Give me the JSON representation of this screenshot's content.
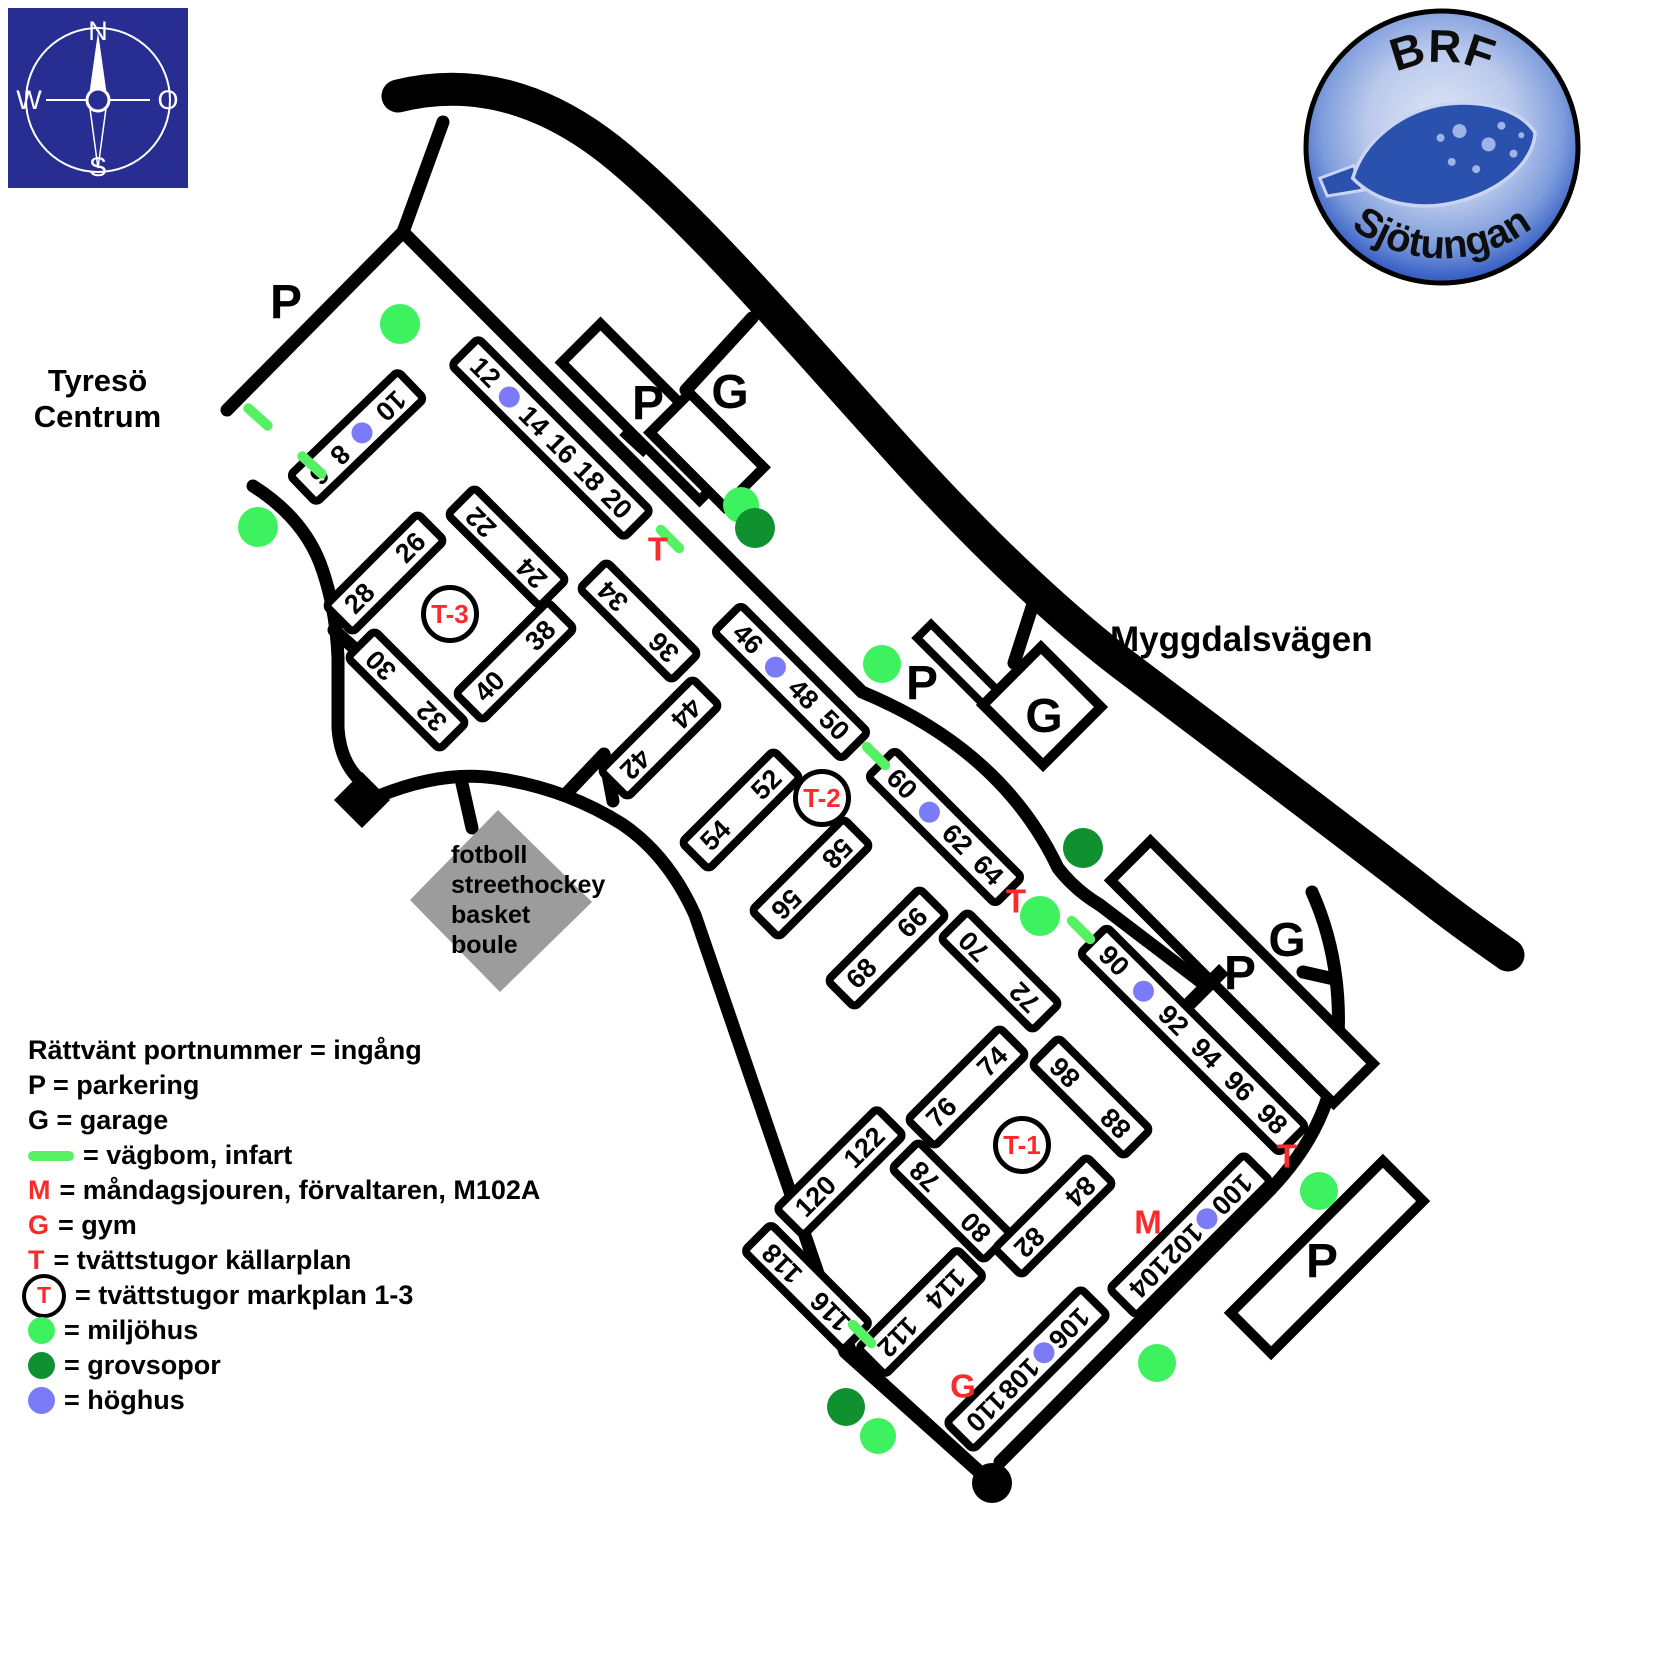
{
  "compass": {
    "n": "N",
    "e": "O",
    "s": "S",
    "w": "W"
  },
  "logo": {
    "top": "BRF",
    "name": "Sjötungan"
  },
  "labels": {
    "area_line1": "Tyresö",
    "area_line2": "Centrum",
    "street": "Myggdalsvägen"
  },
  "sport_field": [
    "fotboll",
    "streethockey",
    "basket",
    "boule"
  ],
  "legend": [
    {
      "sym": "none",
      "text": "Rättvänt portnummer = ingång"
    },
    {
      "sym": "none",
      "text": "P = parkering"
    },
    {
      "sym": "none",
      "text": "G = garage"
    },
    {
      "sym": "line",
      "text": "= vägbom, infart"
    },
    {
      "sym": "M",
      "text": "= måndagsjouren, förvaltaren, M102A"
    },
    {
      "sym": "G",
      "text": "= gym"
    },
    {
      "sym": "T",
      "text": "= tvättstugor källarplan"
    },
    {
      "sym": "circleT",
      "text": "= tvättstugor markplan 1-3"
    },
    {
      "sym": "dot-light",
      "text": "= miljöhus"
    },
    {
      "sym": "dot-dark",
      "text": "= grovsopor"
    },
    {
      "sym": "dot-blue",
      "text": "= höghus"
    }
  ],
  "colors": {
    "miljohus": "#3ef15f",
    "grovsopor": "#0f9130",
    "hoghus": "#7b7bf7",
    "red_letter": "#fb2b2b",
    "vagbom": "#55f163",
    "compass_blue": "#272d91"
  },
  "map": {
    "buildings": [
      {
        "id": "6-10",
        "cx": 357,
        "cy": 437,
        "len": 158,
        "angle": -44,
        "items": [
          {
            "t": "6",
            "flip": true
          },
          {
            "t": "8",
            "flip": true
          },
          {
            "dot": true
          },
          {
            "t": "10",
            "flip": true
          }
        ]
      },
      {
        "id": "12-20",
        "cx": 551,
        "cy": 438,
        "len": 252,
        "angle": 45,
        "items": [
          {
            "t": "12"
          },
          {
            "dot": true
          },
          {
            "t": "14"
          },
          {
            "t": "16"
          },
          {
            "t": "18"
          },
          {
            "t": "20"
          }
        ]
      },
      {
        "id": "22-24",
        "cx": 507,
        "cy": 547,
        "len": 138,
        "angle": 45,
        "items": [
          {
            "t": "22",
            "flip": true
          },
          {
            "t": "24",
            "flip": true
          }
        ]
      },
      {
        "id": "26-28",
        "cx": 385,
        "cy": 573,
        "len": 138,
        "angle": -45,
        "items": [
          {
            "t": "28"
          },
          {
            "t": "26"
          }
        ]
      },
      {
        "id": "30-32",
        "cx": 407,
        "cy": 690,
        "len": 138,
        "angle": 45,
        "items": [
          {
            "t": "30",
            "flip": true
          },
          {
            "t": "32",
            "flip": true
          }
        ]
      },
      {
        "id": "34-36",
        "cx": 639,
        "cy": 621,
        "len": 138,
        "angle": 45,
        "items": [
          {
            "t": "34",
            "flip": true
          },
          {
            "t": "36",
            "flip": true
          }
        ]
      },
      {
        "id": "38-40",
        "cx": 515,
        "cy": 661,
        "len": 138,
        "angle": -45,
        "items": [
          {
            "t": "40"
          },
          {
            "t": "38"
          }
        ]
      },
      {
        "id": "42-44",
        "cx": 660,
        "cy": 738,
        "len": 138,
        "angle": -45,
        "items": [
          {
            "t": "42",
            "flip": true
          },
          {
            "t": "44",
            "flip": true
          }
        ]
      },
      {
        "id": "46-50",
        "cx": 791,
        "cy": 682,
        "len": 188,
        "angle": 45,
        "items": [
          {
            "t": "46"
          },
          {
            "dot": true
          },
          {
            "t": "48"
          },
          {
            "t": "50"
          }
        ]
      },
      {
        "id": "52-54",
        "cx": 741,
        "cy": 810,
        "len": 138,
        "angle": -45,
        "items": [
          {
            "t": "54"
          },
          {
            "t": "52"
          }
        ]
      },
      {
        "id": "56-58",
        "cx": 811,
        "cy": 878,
        "len": 138,
        "angle": -45,
        "items": [
          {
            "t": "56",
            "flip": true
          },
          {
            "t": "58",
            "flip": true
          }
        ]
      },
      {
        "id": "60-64",
        "cx": 945,
        "cy": 827,
        "len": 188,
        "angle": 45,
        "items": [
          {
            "t": "60"
          },
          {
            "dot": true
          },
          {
            "t": "62"
          },
          {
            "t": "64"
          }
        ]
      },
      {
        "id": "66-68",
        "cx": 887,
        "cy": 948,
        "len": 138,
        "angle": -45,
        "items": [
          {
            "t": "68"
          },
          {
            "t": "66"
          }
        ]
      },
      {
        "id": "70-72",
        "cx": 1000,
        "cy": 971,
        "len": 138,
        "angle": 45,
        "items": [
          {
            "t": "70",
            "flip": true
          },
          {
            "t": "72",
            "flip": true
          }
        ]
      },
      {
        "id": "74-76",
        "cx": 967,
        "cy": 1087,
        "len": 138,
        "angle": -45,
        "items": [
          {
            "t": "76"
          },
          {
            "t": "74"
          }
        ]
      },
      {
        "id": "86-88",
        "cx": 1091,
        "cy": 1097,
        "len": 138,
        "angle": 45,
        "items": [
          {
            "t": "86",
            "flip": true
          },
          {
            "t": "88",
            "flip": true
          }
        ]
      },
      {
        "id": "90-98",
        "cx": 1193,
        "cy": 1040,
        "len": 290,
        "angle": 45,
        "items": [
          {
            "t": "90"
          },
          {
            "dot": true
          },
          {
            "t": "92"
          },
          {
            "t": "94"
          },
          {
            "t": "96"
          },
          {
            "t": "98"
          }
        ]
      },
      {
        "id": "78-80",
        "cx": 951,
        "cy": 1201,
        "len": 138,
        "angle": 45,
        "items": [
          {
            "t": "78",
            "flip": true
          },
          {
            "t": "80",
            "flip": true
          }
        ]
      },
      {
        "id": "82-84",
        "cx": 1054,
        "cy": 1216,
        "len": 138,
        "angle": -45,
        "items": [
          {
            "t": "82",
            "flip": true
          },
          {
            "t": "84",
            "flip": true
          }
        ]
      },
      {
        "id": "120-122",
        "cx": 840,
        "cy": 1172,
        "len": 150,
        "angle": -45,
        "items": [
          {
            "t": "120"
          },
          {
            "t": "122"
          }
        ]
      },
      {
        "id": "116-118",
        "cx": 807,
        "cy": 1287,
        "len": 148,
        "angle": 45,
        "items": [
          {
            "t": "118",
            "flip": true
          },
          {
            "t": "116",
            "flip": true
          }
        ]
      },
      {
        "id": "112-114",
        "cx": 921,
        "cy": 1312,
        "len": 148,
        "angle": -45,
        "items": [
          {
            "t": "112",
            "flip": true
          },
          {
            "t": "114",
            "flip": true
          }
        ]
      },
      {
        "id": "106-110",
        "cx": 1027,
        "cy": 1369,
        "len": 198,
        "angle": -45,
        "items": [
          {
            "t": "110",
            "flip": true
          },
          {
            "t": "108",
            "flip": true
          },
          {
            "dot": true
          },
          {
            "t": "106",
            "flip": true
          }
        ]
      },
      {
        "id": "100-104",
        "cx": 1190,
        "cy": 1235,
        "len": 198,
        "angle": -45,
        "items": [
          {
            "t": "104",
            "flip": true
          },
          {
            "t": "102",
            "flip": true
          },
          {
            "dot": true
          },
          {
            "t": "100",
            "flip": true
          }
        ]
      }
    ],
    "letters": [
      {
        "t": "P",
        "x": 286,
        "y": 303,
        "cls": "black"
      },
      {
        "t": "P",
        "x": 648,
        "y": 404,
        "cls": "black"
      },
      {
        "t": "G",
        "x": 730,
        "y": 393,
        "cls": "black"
      },
      {
        "t": "P",
        "x": 922,
        "y": 684,
        "cls": "black"
      },
      {
        "t": "G",
        "x": 1044,
        "y": 717,
        "cls": "black"
      },
      {
        "t": "G",
        "x": 1287,
        "y": 941,
        "cls": "black"
      },
      {
        "t": "P",
        "x": 1240,
        "y": 974,
        "cls": "black"
      },
      {
        "t": "P",
        "x": 1322,
        "y": 1262,
        "cls": "black"
      },
      {
        "t": "T",
        "x": 658,
        "y": 549,
        "cls": "red"
      },
      {
        "t": "T",
        "x": 1016,
        "y": 901,
        "cls": "red"
      },
      {
        "t": "T",
        "x": 1287,
        "y": 1156,
        "cls": "red"
      },
      {
        "t": "M",
        "x": 1148,
        "y": 1222,
        "cls": "red"
      },
      {
        "t": "G",
        "x": 963,
        "y": 1386,
        "cls": "red"
      }
    ],
    "t_circles": [
      {
        "t": "T-3",
        "x": 450,
        "y": 614
      },
      {
        "t": "T-2",
        "x": 822,
        "y": 798
      },
      {
        "t": "T-1",
        "x": 1022,
        "y": 1145
      }
    ],
    "dots": [
      {
        "type": "miljohus",
        "x": 400,
        "y": 324,
        "r": 20
      },
      {
        "type": "miljohus",
        "x": 258,
        "y": 527,
        "r": 20
      },
      {
        "type": "miljohus",
        "x": 741,
        "y": 505,
        "r": 18
      },
      {
        "type": "miljohus",
        "x": 882,
        "y": 664,
        "r": 19
      },
      {
        "type": "miljohus",
        "x": 1040,
        "y": 916,
        "r": 20
      },
      {
        "type": "miljohus",
        "x": 1319,
        "y": 1191,
        "r": 19
      },
      {
        "type": "miljohus",
        "x": 1157,
        "y": 1363,
        "r": 19
      },
      {
        "type": "miljohus",
        "x": 878,
        "y": 1436,
        "r": 18
      },
      {
        "type": "grovsopor",
        "x": 755,
        "y": 528,
        "r": 20
      },
      {
        "type": "grovsopor",
        "x": 1083,
        "y": 848,
        "r": 20
      },
      {
        "type": "grovsopor",
        "x": 846,
        "y": 1407,
        "r": 19
      }
    ],
    "vagbom": [
      {
        "x": 258,
        "y": 417,
        "a": 42
      },
      {
        "x": 312,
        "y": 465,
        "a": 42
      },
      {
        "x": 670,
        "y": 539,
        "a": 45
      },
      {
        "x": 876,
        "y": 756,
        "a": 45
      },
      {
        "x": 1081,
        "y": 930,
        "a": 45
      },
      {
        "x": 862,
        "y": 1334,
        "a": 45
      }
    ]
  }
}
